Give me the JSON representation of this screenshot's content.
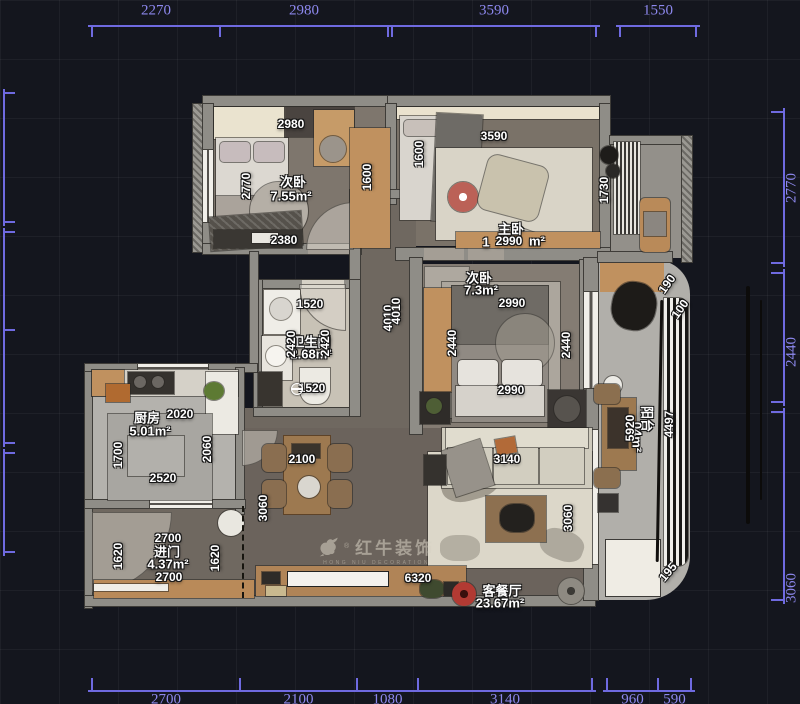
{
  "watermark": {
    "brand": "红牛装饰",
    "registered": "®",
    "sub": "HONG NIU DECORATION"
  },
  "plan_labels": [
    {
      "text": "次卧",
      "x": 293,
      "y": 181,
      "kind": "room"
    },
    {
      "text": "7.55m²",
      "x": 291,
      "y": 196,
      "kind": "room"
    },
    {
      "text": "主卧",
      "x": 511,
      "y": 228,
      "kind": "room"
    },
    {
      "text": "1",
      "x": 486,
      "y": 242,
      "kind": "room"
    },
    {
      "text": "m²",
      "x": 537,
      "y": 241,
      "kind": "room"
    },
    {
      "text": "次卧",
      "x": 479,
      "y": 277,
      "kind": "room"
    },
    {
      "text": "7.3m²",
      "x": 481,
      "y": 290,
      "kind": "room"
    },
    {
      "text": "卫生间",
      "x": 311,
      "y": 341,
      "kind": "room"
    },
    {
      "text": "2.68m²",
      "x": 311,
      "y": 354,
      "kind": "room"
    },
    {
      "text": "厨房",
      "x": 147,
      "y": 417,
      "kind": "room"
    },
    {
      "text": "5.01m²",
      "x": 150,
      "y": 431,
      "kind": "room"
    },
    {
      "text": "进门",
      "x": 167,
      "y": 551,
      "kind": "room"
    },
    {
      "text": "4.37m²",
      "x": 168,
      "y": 564,
      "kind": "room"
    },
    {
      "text": "客餐厅",
      "x": 502,
      "y": 590,
      "kind": "room"
    },
    {
      "text": "23.67m²",
      "x": 500,
      "y": 603,
      "kind": "room"
    },
    {
      "text": "阳台",
      "x": 648,
      "y": 419,
      "kind": "room",
      "rot": 90
    },
    {
      "text": "04m²",
      "x": 637,
      "y": 437,
      "kind": "room",
      "rot": 90
    },
    {
      "text": "2980",
      "x": 291,
      "y": 124
    },
    {
      "text": "1600",
      "x": 367,
      "y": 177,
      "rot": -90
    },
    {
      "text": "2770",
      "x": 246,
      "y": 186,
      "rot": -90
    },
    {
      "text": "2380",
      "x": 284,
      "y": 240
    },
    {
      "text": "3590",
      "x": 494,
      "y": 136
    },
    {
      "text": "1600",
      "x": 419,
      "y": 154,
      "rot": -90
    },
    {
      "text": "1730",
      "x": 604,
      "y": 190,
      "rot": -90
    },
    {
      "text": "2990",
      "x": 509,
      "y": 241
    },
    {
      "text": "2990",
      "x": 512,
      "y": 303
    },
    {
      "text": "2440",
      "x": 452,
      "y": 343,
      "rot": -90
    },
    {
      "text": "2440",
      "x": 566,
      "y": 345,
      "rot": -90
    },
    {
      "text": "2990",
      "x": 511,
      "y": 390
    },
    {
      "text": "1520",
      "x": 310,
      "y": 304
    },
    {
      "text": "2420",
      "x": 291,
      "y": 344,
      "rot": -90
    },
    {
      "text": "2420",
      "x": 325,
      "y": 343,
      "rot": -90
    },
    {
      "text": "1520",
      "x": 312,
      "y": 388
    },
    {
      "text": "4010",
      "x": 388,
      "y": 318,
      "rot": -90
    },
    {
      "text": "4010",
      "x": 396,
      "y": 311,
      "rot": -90
    },
    {
      "text": "2020",
      "x": 180,
      "y": 414
    },
    {
      "text": "1700",
      "x": 118,
      "y": 455,
      "rot": -90
    },
    {
      "text": "2060",
      "x": 207,
      "y": 449,
      "rot": -90
    },
    {
      "text": "2520",
      "x": 163,
      "y": 478
    },
    {
      "text": "2700",
      "x": 168,
      "y": 538
    },
    {
      "text": "2700",
      "x": 169,
      "y": 577
    },
    {
      "text": "1620",
      "x": 118,
      "y": 556,
      "rot": -90
    },
    {
      "text": "1620",
      "x": 215,
      "y": 558,
      "rot": -90
    },
    {
      "text": "3060",
      "x": 263,
      "y": 508,
      "rot": -90
    },
    {
      "text": "2100",
      "x": 302,
      "y": 459
    },
    {
      "text": "3140",
      "x": 507,
      "y": 459
    },
    {
      "text": "3060",
      "x": 568,
      "y": 518,
      "rot": -90
    },
    {
      "text": "6320",
      "x": 418,
      "y": 578
    },
    {
      "text": "5920",
      "x": 630,
      "y": 428,
      "rot": -90
    },
    {
      "text": "4497",
      "x": 669,
      "y": 424,
      "rot": -90
    },
    {
      "text": "190",
      "x": 667,
      "y": 284,
      "rot": -55
    },
    {
      "text": "100",
      "x": 680,
      "y": 309,
      "rot": -55
    },
    {
      "text": "195",
      "x": 668,
      "y": 572,
      "rot": -50
    }
  ],
  "dim_groups": [
    {
      "name": "top",
      "orient": "h",
      "line": 25,
      "label_side": -14,
      "tick": 12,
      "segments": [
        {
          "a": 92,
          "b": 220,
          "label": "2270"
        },
        {
          "a": 220,
          "b": 388,
          "label": "2980"
        },
        {
          "a": 392,
          "b": 596,
          "label": "3590"
        },
        {
          "a": 620,
          "b": 696,
          "label": "1550"
        }
      ]
    },
    {
      "name": "bottom",
      "orient": "h",
      "line": 690,
      "label_side": 10,
      "tick": -12,
      "segments": [
        {
          "a": 92,
          "b": 240,
          "label": "2700"
        },
        {
          "a": 240,
          "b": 357,
          "label": "2100"
        },
        {
          "a": 357,
          "b": 418,
          "label": "1080"
        },
        {
          "a": 418,
          "b": 592,
          "label": "3140"
        },
        {
          "a": 607,
          "b": 658,
          "label": "960"
        },
        {
          "a": 658,
          "b": 691,
          "label": "590"
        }
      ]
    },
    {
      "name": "right",
      "orient": "v",
      "line": 783,
      "label_side": 9,
      "tick": -12,
      "segments": [
        {
          "a": 112,
          "b": 263,
          "label": "2770"
        },
        {
          "a": 273,
          "b": 402,
          "label": "2440",
          "label_at": 352
        },
        {
          "a": 412,
          "b": 600,
          "label": "3060",
          "label_at": 588
        }
      ]
    },
    {
      "name": "left",
      "orient": "v",
      "line": 3,
      "label_side": -9,
      "tick": 12,
      "segments": [
        {
          "a": 93,
          "b": 222,
          "label": ""
        },
        {
          "a": 232,
          "b": 330,
          "label": ""
        },
        {
          "a": 330,
          "b": 443,
          "label": ""
        },
        {
          "a": 453,
          "b": 552,
          "label": ""
        }
      ]
    }
  ]
}
